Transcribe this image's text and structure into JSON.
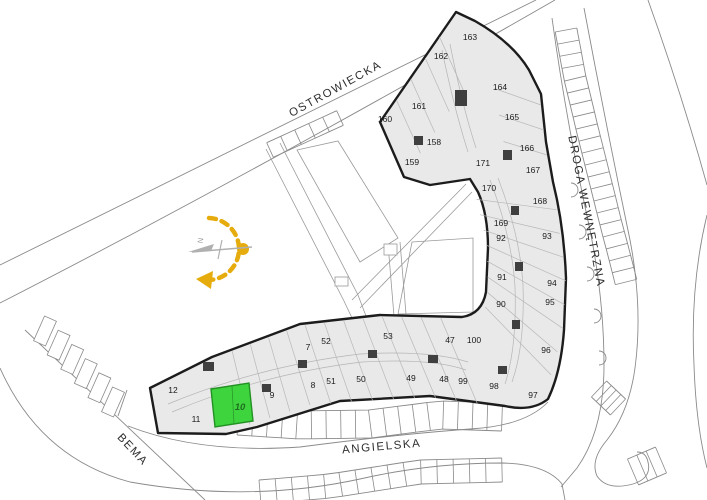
{
  "colors": {
    "highlight": "#3ed43e",
    "highlight_border": "#239123",
    "sun": "#e6ac0d",
    "building_fill": "#e9e9e9",
    "wall": "#1c1c1c",
    "road": "#8a8a8a"
  },
  "selected_unit": "10",
  "compass": {
    "north_label": "N"
  },
  "streets": [
    {
      "name": "OSTROWIECKA",
      "x": 337,
      "y": 92,
      "rotation": -29
    },
    {
      "name": "DROGA WEWNĘTRZNA",
      "x": 583,
      "y": 212,
      "rotation": 79
    },
    {
      "name": "ANGIELSKA",
      "x": 382,
      "y": 450,
      "rotation": -5
    },
    {
      "name": "BEMA",
      "x": 130,
      "y": 452,
      "rotation": 47
    }
  ],
  "units": [
    {
      "n": "160",
      "x": 385,
      "y": 119
    },
    {
      "n": "161",
      "x": 419,
      "y": 106
    },
    {
      "n": "162",
      "x": 441,
      "y": 56
    },
    {
      "n": "163",
      "x": 470,
      "y": 37
    },
    {
      "n": "158",
      "x": 434,
      "y": 142
    },
    {
      "n": "159",
      "x": 412,
      "y": 162
    },
    {
      "n": "164",
      "x": 500,
      "y": 87
    },
    {
      "n": "165",
      "x": 512,
      "y": 117
    },
    {
      "n": "166",
      "x": 527,
      "y": 148
    },
    {
      "n": "171",
      "x": 483,
      "y": 163
    },
    {
      "n": "167",
      "x": 533,
      "y": 170
    },
    {
      "n": "170",
      "x": 489,
      "y": 188
    },
    {
      "n": "168",
      "x": 540,
      "y": 201
    },
    {
      "n": "169",
      "x": 501,
      "y": 223
    },
    {
      "n": "92",
      "x": 501,
      "y": 238
    },
    {
      "n": "93",
      "x": 547,
      "y": 236
    },
    {
      "n": "91",
      "x": 502,
      "y": 277
    },
    {
      "n": "94",
      "x": 552,
      "y": 283
    },
    {
      "n": "90",
      "x": 501,
      "y": 304
    },
    {
      "n": "95",
      "x": 550,
      "y": 302
    },
    {
      "n": "96",
      "x": 546,
      "y": 350
    },
    {
      "n": "97",
      "x": 533,
      "y": 395
    },
    {
      "n": "98",
      "x": 494,
      "y": 386
    },
    {
      "n": "99",
      "x": 463,
      "y": 381
    },
    {
      "n": "100",
      "x": 474,
      "y": 340
    },
    {
      "n": "48",
      "x": 444,
      "y": 379
    },
    {
      "n": "47",
      "x": 450,
      "y": 340
    },
    {
      "n": "53",
      "x": 388,
      "y": 336
    },
    {
      "n": "52",
      "x": 326,
      "y": 341
    },
    {
      "n": "51",
      "x": 331,
      "y": 381
    },
    {
      "n": "50",
      "x": 361,
      "y": 379
    },
    {
      "n": "49",
      "x": 411,
      "y": 378
    },
    {
      "n": "7",
      "x": 308,
      "y": 347
    },
    {
      "n": "8",
      "x": 313,
      "y": 385
    },
    {
      "n": "12",
      "x": 173,
      "y": 390
    },
    {
      "n": "11",
      "x": 196,
      "y": 419
    },
    {
      "n": "9",
      "x": 272,
      "y": 395
    },
    {
      "n": "10",
      "x": 240,
      "y": 407,
      "h": true
    }
  ]
}
